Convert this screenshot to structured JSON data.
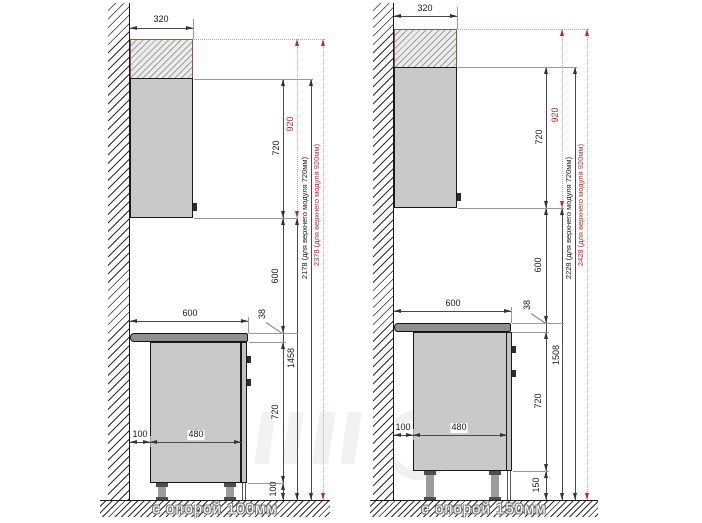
{
  "panels": [
    {
      "id": "support-100",
      "floor_label": "с опорой 100мм",
      "dims": {
        "upper_depth": "320",
        "upper_height": "720",
        "upper_height_alt": "920",
        "wall_gap": "600",
        "countertop_width": "600",
        "countertop_thickness": "38",
        "base_height": "720",
        "leg_height": "100",
        "back_gap": "100",
        "base_depth": "480",
        "floor_to_upper": "1458",
        "total_std": "2178 (для верхнего модуля 720мм)",
        "total_alt": "2378 (для верхнего модуля 920мм)"
      }
    },
    {
      "id": "support-150",
      "floor_label": "с опорой 150мм",
      "dims": {
        "upper_depth": "320",
        "upper_height": "720",
        "upper_height_alt": "920",
        "wall_gap": "600",
        "countertop_width": "600",
        "countertop_thickness": "38",
        "base_height": "720",
        "leg_height": "150",
        "back_gap": "100",
        "base_depth": "480",
        "floor_to_upper": "1508",
        "total_std": "2228 (для верхнего модуля 720мм)",
        "total_alt": "2428 (для верхнего модуля 920мм)"
      }
    }
  ]
}
